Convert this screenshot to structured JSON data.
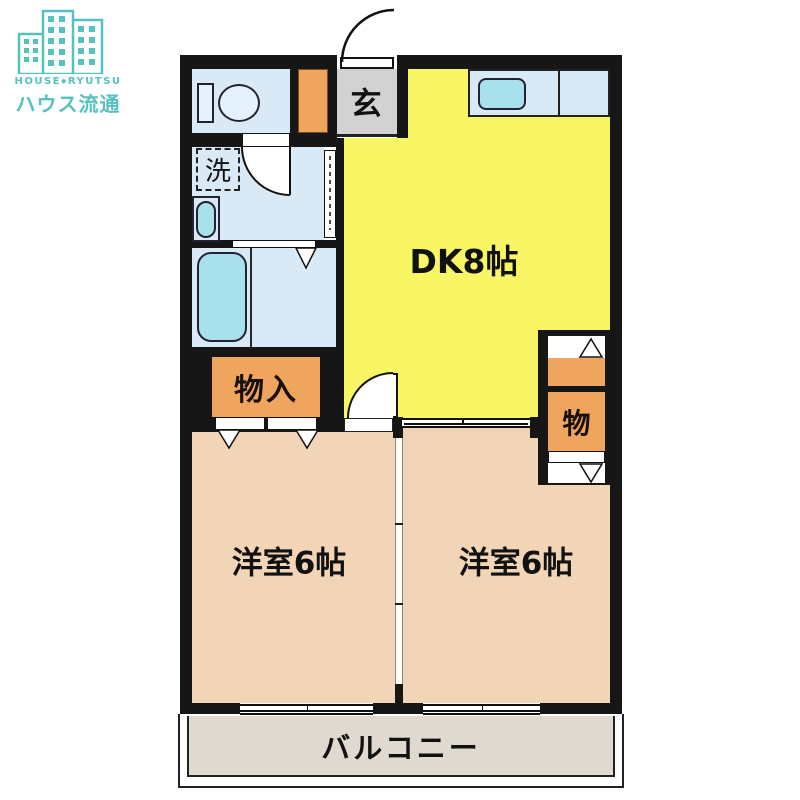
{
  "logo": {
    "romaji_left": "HOUSE",
    "separator": "◆",
    "romaji_right": "RYUTSU",
    "name_jp": "ハウス流通",
    "brand_color": "#56C2C0"
  },
  "plan": {
    "dk_label": "DK8帖",
    "entrance_label": "玄",
    "laundry_label": "洗",
    "closet_label": "物入",
    "storage_label": "物",
    "bedroom_left_label": "洋室6帖",
    "bedroom_right_label": "洋室6帖",
    "balcony_label": "バルコニー"
  },
  "colors": {
    "wall": "#161616",
    "dk_yellow": "#F9F666",
    "bedroom_pink": "#F2D4B6",
    "water_blue": "#DAE9F6",
    "fixture_cyan": "#A8E0EC",
    "storage_orange": "#EFA55E",
    "entrance_gray": "#D2D2D2",
    "balcony_beige": "#E0D9CF",
    "brand_teal": "#56C2C0"
  }
}
